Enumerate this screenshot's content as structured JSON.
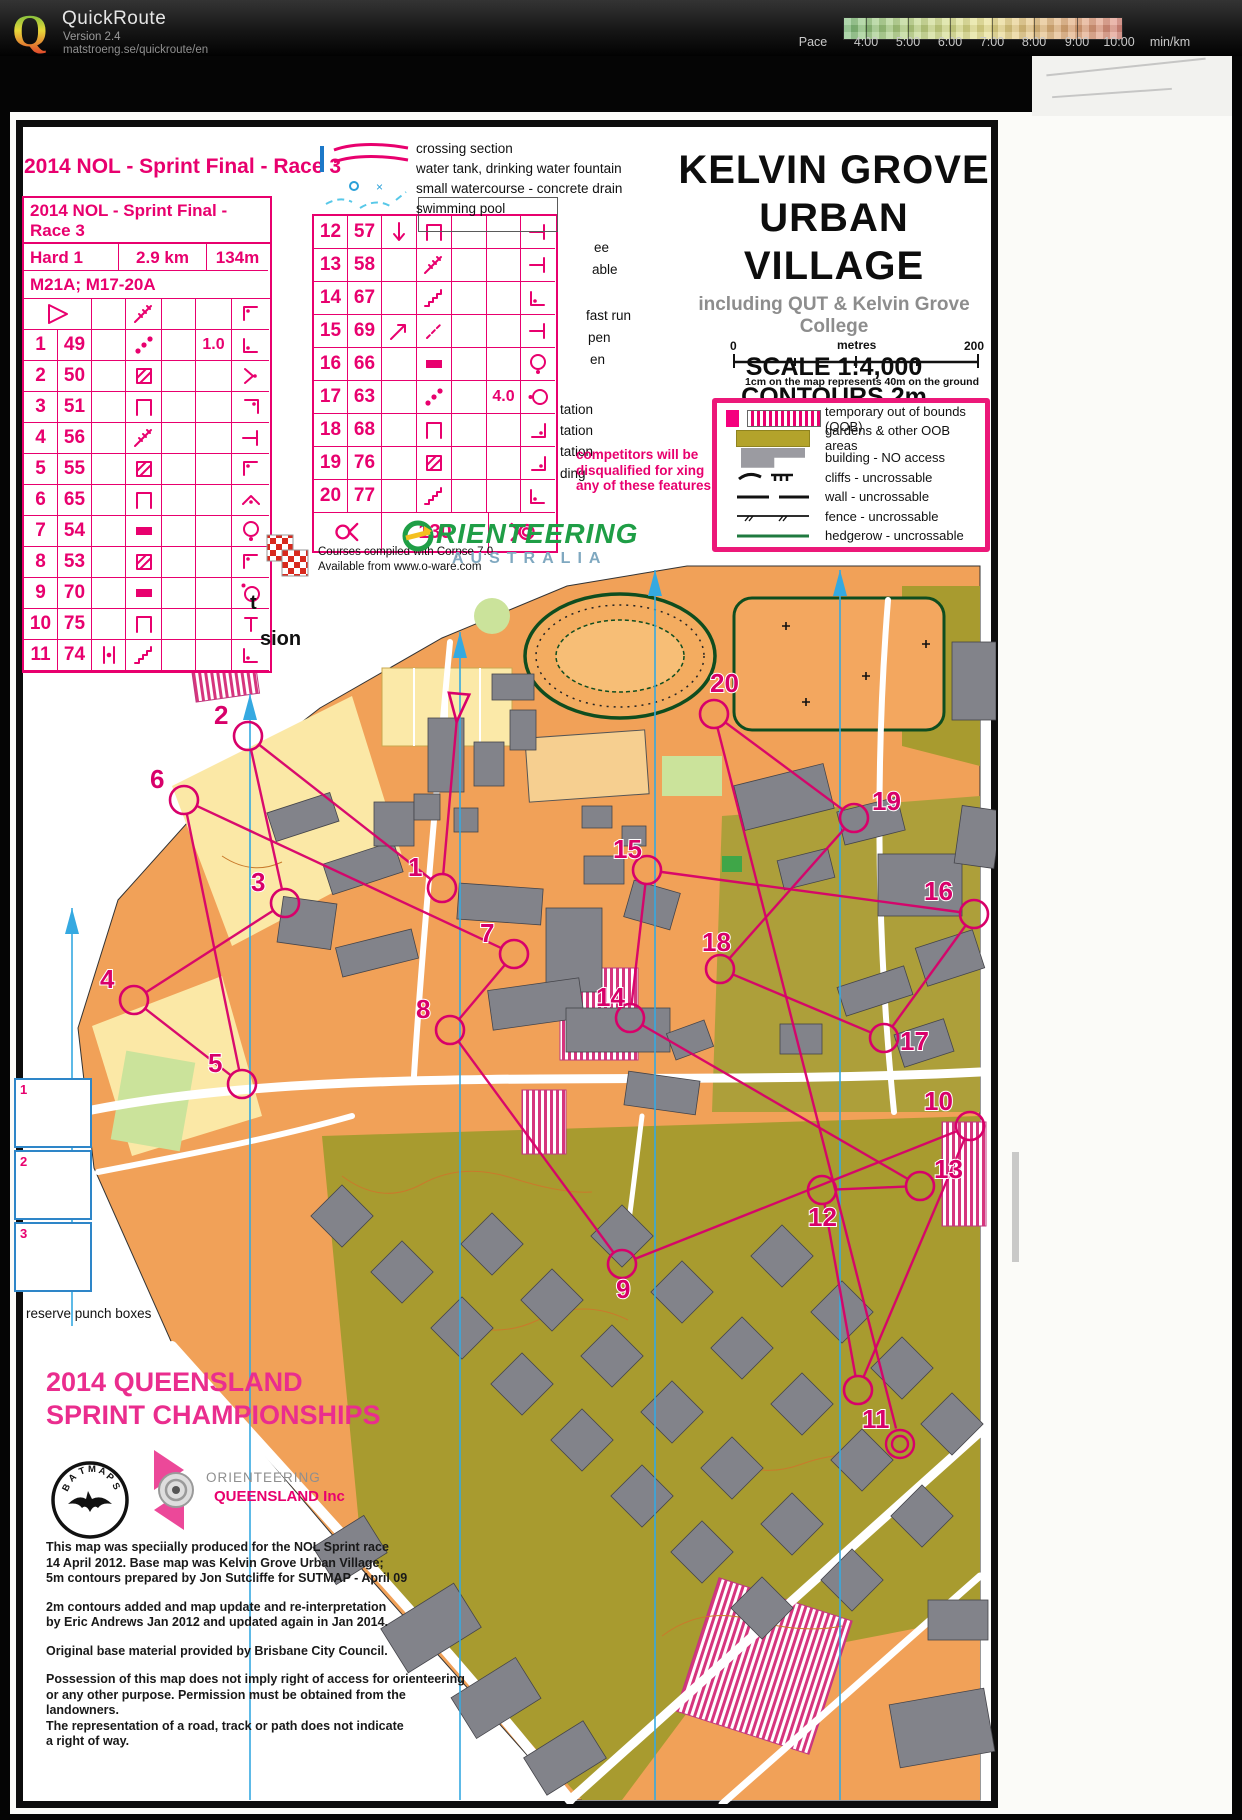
{
  "header": {
    "app_title": "QuickRoute",
    "version": "Version 2.4",
    "site": "matstroeng.se/quickroute/en",
    "pace_label": "Pace",
    "pace_unit": "min/km",
    "pace_ticks": [
      "4:00",
      "5:00",
      "6:00",
      "7:00",
      "8:00",
      "9:00",
      "10:00"
    ]
  },
  "course_sheet": {
    "outer_title": "2014 NOL - Sprint Final - Race 3",
    "inner_title": "2014 NOL - Sprint Final - Race 3",
    "course": "Hard 1",
    "length": "2.9 km",
    "climb": "134m",
    "classes": "M21A; M17-20A",
    "start_row": {
      "d": "stairway",
      "h": "corner-nw"
    },
    "left_rows": [
      {
        "n": "1",
        "code": "49",
        "c": "",
        "d": "dots-diag",
        "e": "",
        "f": "1.0",
        "h": "corner-sw"
      },
      {
        "n": "2",
        "code": "50",
        "c": "",
        "d": "hatch-sq",
        "e": "",
        "f": "",
        "h": "junction"
      },
      {
        "n": "3",
        "code": "51",
        "c": "",
        "d": "canopy",
        "e": "",
        "f": "",
        "h": "corner-ne"
      },
      {
        "n": "4",
        "code": "56",
        "c": "",
        "d": "stairway",
        "e": "",
        "f": "",
        "h": "t-bar"
      },
      {
        "n": "5",
        "code": "55",
        "c": "",
        "d": "hatch-sq",
        "e": "",
        "f": "",
        "h": "corner-nw"
      },
      {
        "n": "6",
        "code": "65",
        "c": "",
        "d": "canopy",
        "e": "",
        "f": "",
        "h": "bend"
      },
      {
        "n": "7",
        "code": "54",
        "c": "",
        "d": "filled-rect",
        "e": "",
        "f": "",
        "h": "circle-dot-bottom"
      },
      {
        "n": "8",
        "code": "53",
        "c": "",
        "d": "hatch-sq",
        "e": "",
        "f": "",
        "h": "corner-nw"
      },
      {
        "n": "9",
        "code": "70",
        "c": "",
        "d": "filled-rect",
        "e": "",
        "f": "",
        "h": "circle-dot-topleft"
      },
      {
        "n": "10",
        "code": "75",
        "c": "",
        "d": "canopy",
        "e": "",
        "f": "",
        "h": "t-down"
      },
      {
        "n": "11",
        "code": "74",
        "c": "between",
        "d": "steps",
        "e": "",
        "f": "",
        "h": "corner-sw"
      }
    ],
    "right_rows": [
      {
        "n": "12",
        "code": "57",
        "c": "down-arrow",
        "d": "canopy",
        "e": "",
        "f": "",
        "h": "t-bar"
      },
      {
        "n": "13",
        "code": "58",
        "c": "",
        "d": "stairway",
        "e": "",
        "f": "",
        "h": "t-bar"
      },
      {
        "n": "14",
        "code": "67",
        "c": "",
        "d": "steps",
        "e": "",
        "f": "",
        "h": "corner-sw"
      },
      {
        "n": "15",
        "code": "69",
        "c": "ne-arrow",
        "d": "dashed-diag",
        "e": "",
        "f": "",
        "h": "t-bar"
      },
      {
        "n": "16",
        "code": "66",
        "c": "",
        "d": "filled-rect",
        "e": "",
        "f": "",
        "h": "circle-dot-bottom"
      },
      {
        "n": "17",
        "code": "63",
        "c": "",
        "d": "dots-diag",
        "e": "",
        "f": "4.0",
        "h": "circle-dot-left"
      },
      {
        "n": "18",
        "code": "68",
        "c": "",
        "d": "canopy",
        "e": "",
        "f": "",
        "h": "corner-se"
      },
      {
        "n": "19",
        "code": "76",
        "c": "",
        "d": "hatch-sq",
        "e": "",
        "f": "",
        "h": "corner-se"
      },
      {
        "n": "20",
        "code": "77",
        "c": "",
        "d": "steps",
        "e": "",
        "f": "",
        "h": "corner-sw"
      }
    ],
    "finish_label": "130"
  },
  "top_legend": {
    "items": [
      "crossing section",
      "water tank, drinking water fountain",
      "small watercourse - concrete drain",
      "swimming pool"
    ]
  },
  "fragments": [
    {
      "t": "t",
      "x": 250,
      "y": 592,
      "k": "big"
    },
    {
      "t": "sion",
      "x": 260,
      "y": 628,
      "k": "big"
    },
    {
      "t": "ee",
      "x": 594,
      "y": 240,
      "k": "s"
    },
    {
      "t": "able",
      "x": 592,
      "y": 262,
      "k": "s"
    },
    {
      "t": "fast run",
      "x": 586,
      "y": 308,
      "k": "s"
    },
    {
      "t": "pen",
      "x": 588,
      "y": 330,
      "k": "s"
    },
    {
      "t": "en",
      "x": 590,
      "y": 352,
      "k": "s"
    },
    {
      "t": "tation",
      "x": 560,
      "y": 402,
      "k": "s"
    },
    {
      "t": "tation",
      "x": 560,
      "y": 423,
      "k": "s"
    },
    {
      "t": "tation",
      "x": 560,
      "y": 444,
      "k": "s"
    },
    {
      "t": "ding",
      "x": 560,
      "y": 466,
      "k": "s"
    }
  ],
  "title_block": {
    "title1": "KELVIN GROVE",
    "title2": "URBAN VILLAGE",
    "subtitle": "including QUT & Kelvin Grove College",
    "scale": "SCALE 1:4,000",
    "contours": "CONTOURS 2m",
    "scalebar": {
      "zero": "0",
      "mid": "metres",
      "max": "200",
      "note": "1cm on the map represents 40m on the ground"
    }
  },
  "oob_legend": [
    {
      "sw": "stripes",
      "label": "temporary out of bounds (OOB)"
    },
    {
      "sw": "olive",
      "label": "gardens & other OOB areas"
    },
    {
      "sw": "building",
      "label": "building - NO access"
    },
    {
      "sw": "cliffs",
      "label": "cliffs - uncrossable"
    },
    {
      "sw": "wall",
      "label": "wall - uncrossable"
    },
    {
      "sw": "fence",
      "label": "fence - uncrossable"
    },
    {
      "sw": "hedge",
      "label": "hedgerow - uncrossable"
    }
  ],
  "warning": [
    "competitors will be",
    "disqualified for xing",
    "any of these features"
  ],
  "software_credit": [
    "Courses compiled with Corpse 7.0",
    "Available from www.o-ware.com"
  ],
  "oa_logo": {
    "line1": "RIENTEERING",
    "line2": "AUSTRALIA"
  },
  "punch": {
    "label": "reserve punch boxes",
    "boxes": [
      "1",
      "2",
      "3"
    ]
  },
  "champs": [
    "2014 QUEENSLAND",
    "SPRINT CHAMPIONSHIPS"
  ],
  "oq_logo": {
    "line1": "ORIENTEERING",
    "line2": "QUEENSLAND Inc"
  },
  "bat_logo": "BATMAPS",
  "credits": [
    [
      "This map was speciially produced for the NOL Sprint race",
      "14 April 2012. Base map was Kelvin Grove Urban Village;",
      "5m contours prepared by Jon Sutcliffe for SUTMAP - April 09"
    ],
    [
      "2m contours added and map update and re-interpretation",
      "by Eric Andrews Jan 2012 and updated again in Jan 2014."
    ],
    [
      "Original base material provided by Brisbane City Council."
    ],
    [
      "Possession of this map does not imply right of access for orienteering",
      "or any other purpose. Permission must be obtained from the landowners.",
      "The representation of a road, track or path does not indicate",
      "a right of way."
    ]
  ],
  "map": {
    "start": {
      "x": 436,
      "y": 150
    },
    "finish": {
      "x": 878,
      "y": 888
    },
    "controls": [
      {
        "n": 1,
        "x": 420,
        "y": 332
      },
      {
        "n": 2,
        "x": 226,
        "y": 180
      },
      {
        "n": 3,
        "x": 263,
        "y": 347
      },
      {
        "n": 4,
        "x": 112,
        "y": 444
      },
      {
        "n": 5,
        "x": 220,
        "y": 528
      },
      {
        "n": 6,
        "x": 162,
        "y": 244
      },
      {
        "n": 7,
        "x": 492,
        "y": 398
      },
      {
        "n": 8,
        "x": 428,
        "y": 474
      },
      {
        "n": 9,
        "x": 600,
        "y": 708,
        "lx": -6,
        "ly": 34
      },
      {
        "n": 10,
        "x": 948,
        "y": 570,
        "lx": -46,
        "ly": -16
      },
      {
        "n": 11,
        "x": 836,
        "y": 834,
        "lx": 4,
        "ly": 38
      },
      {
        "n": 12,
        "x": 800,
        "y": 634,
        "lx": -14,
        "ly": 36
      },
      {
        "n": 13,
        "x": 898,
        "y": 630,
        "lx": 14,
        "ly": -8
      },
      {
        "n": 14,
        "x": 608,
        "y": 462
      },
      {
        "n": 15,
        "x": 625,
        "y": 314
      },
      {
        "n": 16,
        "x": 952,
        "y": 358,
        "lx": -50,
        "ly": -14
      },
      {
        "n": 17,
        "x": 862,
        "y": 482,
        "lx": 16,
        "ly": 12
      },
      {
        "n": 18,
        "x": 698,
        "y": 413,
        "lx": -18,
        "ly": -18
      },
      {
        "n": 19,
        "x": 832,
        "y": 262,
        "lx": 18,
        "ly": -8
      },
      {
        "n": 20,
        "x": 692,
        "y": 158,
        "lx": -4,
        "ly": -22
      }
    ]
  },
  "colors": {
    "sheet_magenta": "#E8006E",
    "course_magenta": "#D8006A",
    "map_orange": "#F1A158",
    "oob_olive": "#A89B2F",
    "building_grey": "#82838A",
    "north_blue": "#35A9E1"
  }
}
